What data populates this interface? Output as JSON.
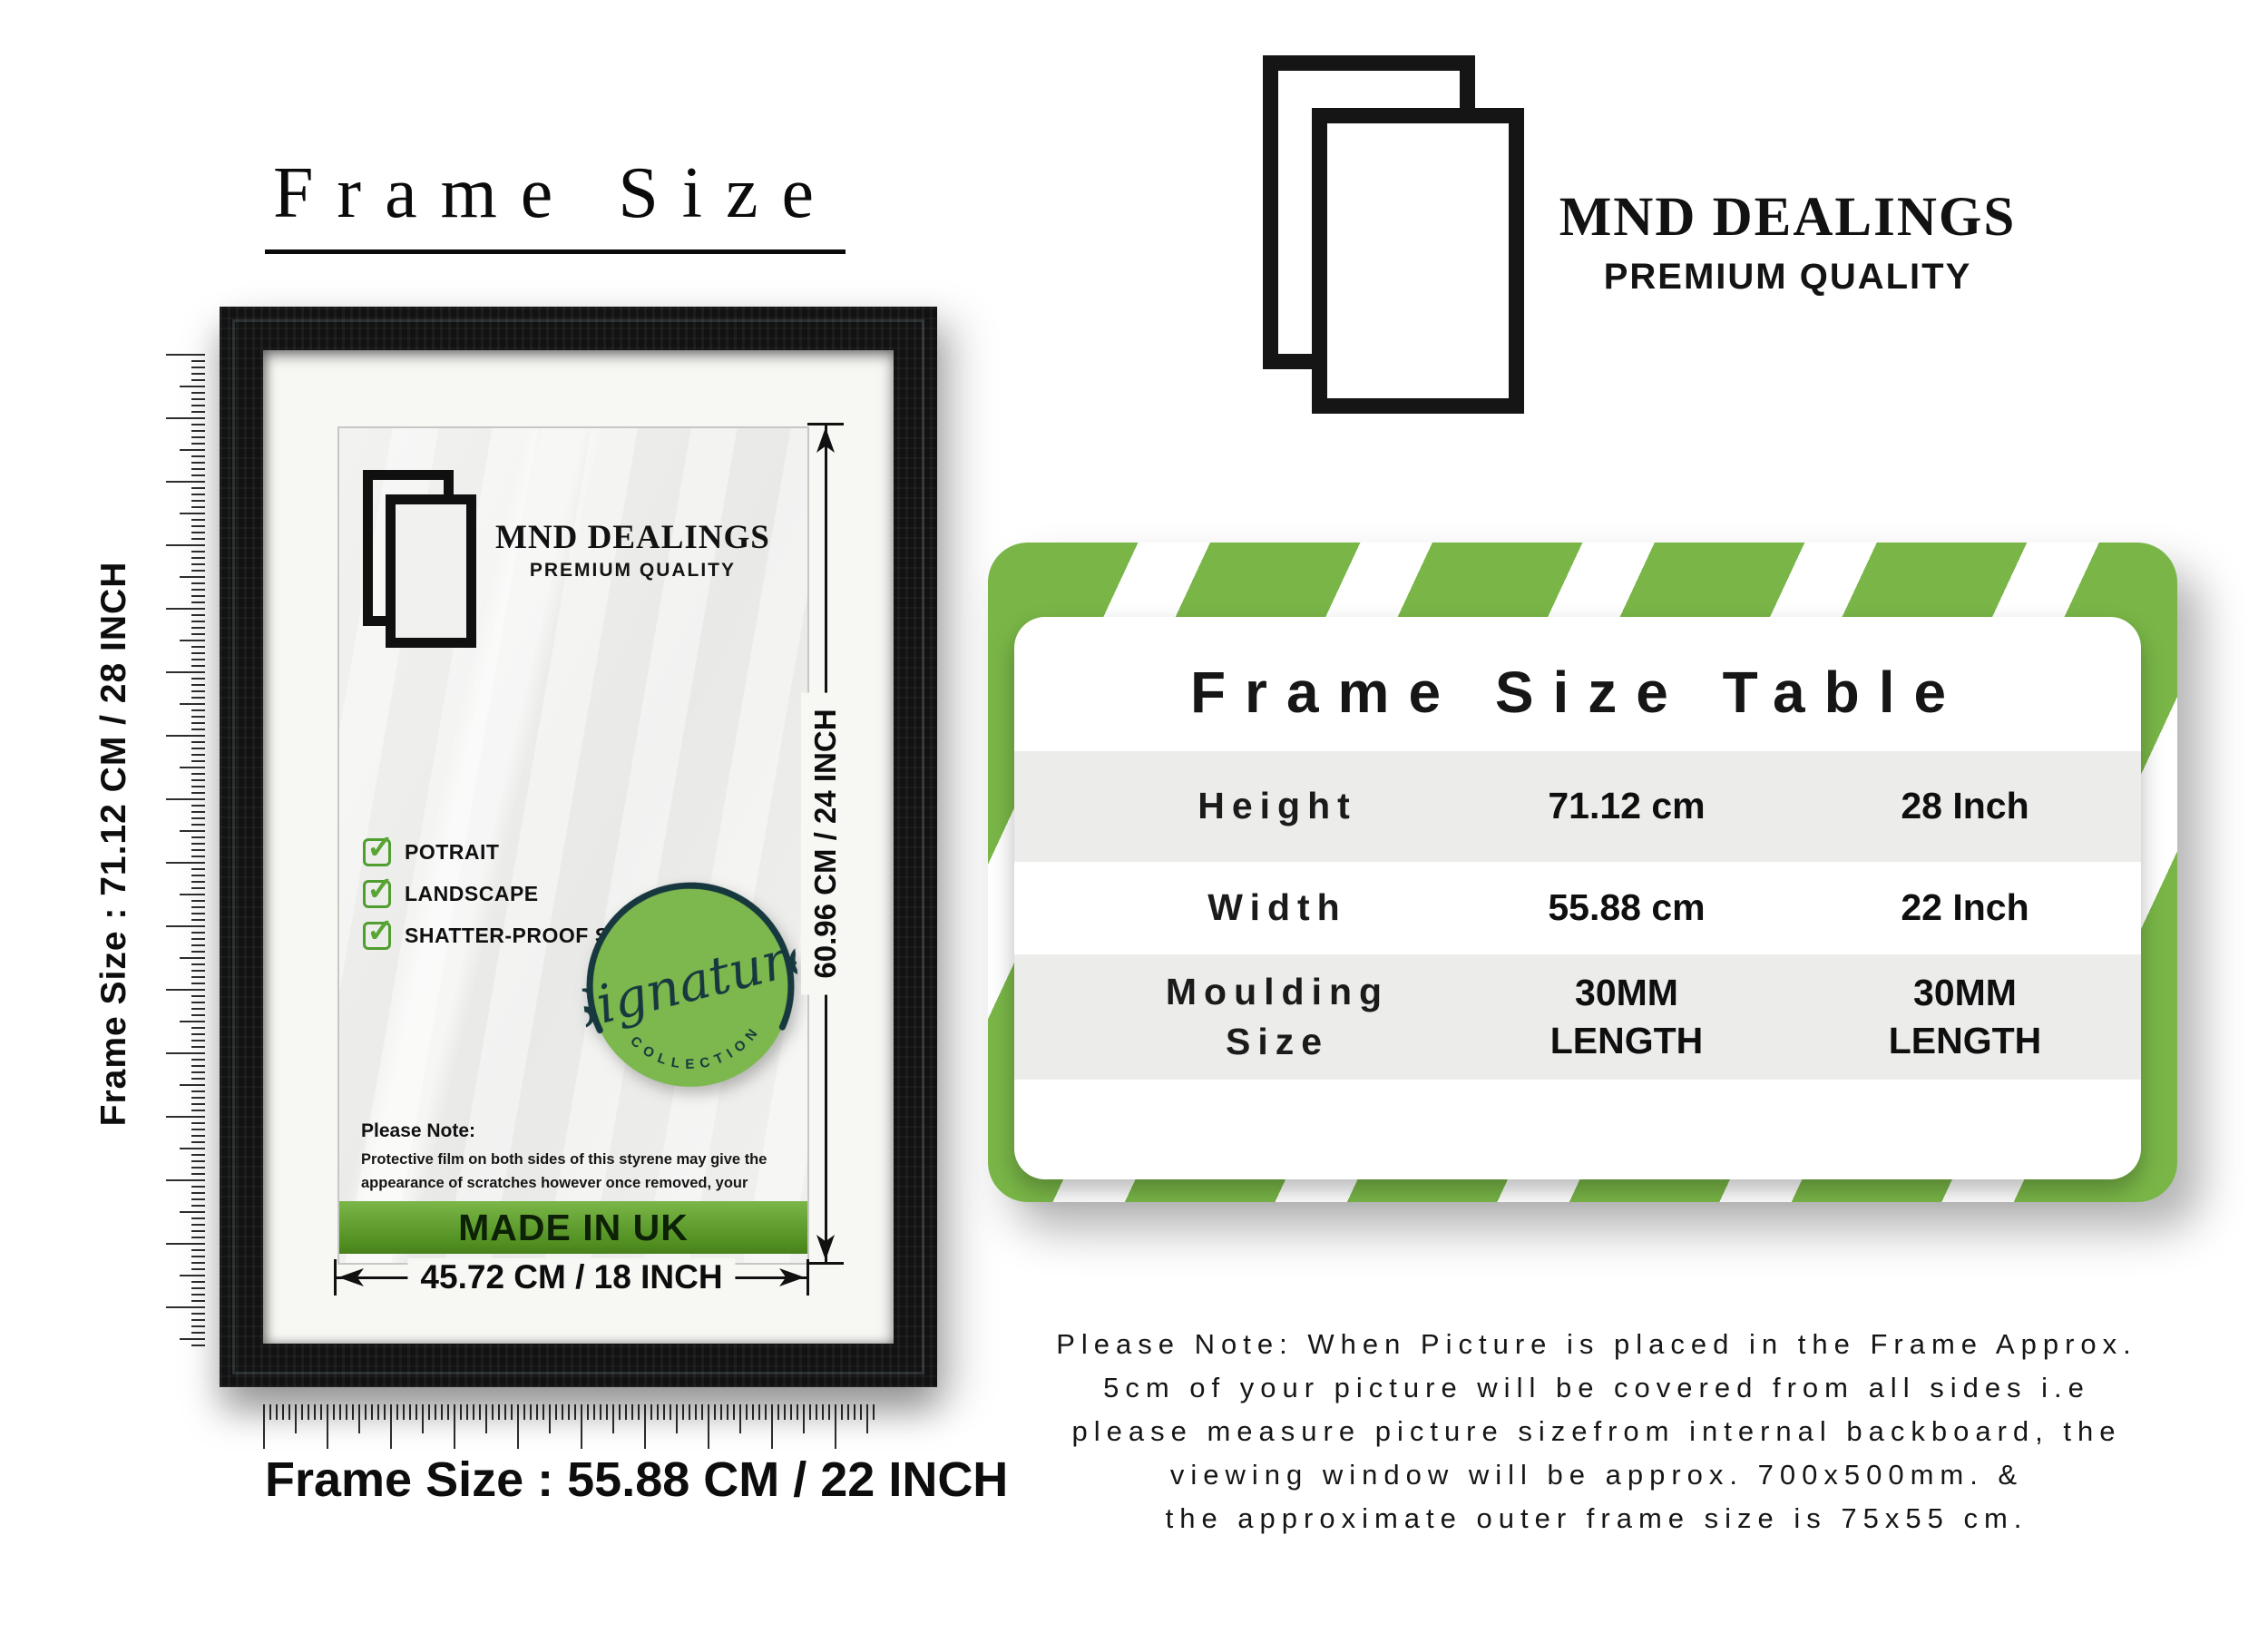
{
  "left": {
    "title": "Frame Size",
    "height_label": "Frame Size : 71.12 CM / 28 INCH",
    "width_label": "Frame Size : 55.88 CM / 22 INCH"
  },
  "frame": {
    "logo": {
      "name": "MND DEALINGS",
      "tagline": "PREMIUM QUALITY"
    },
    "features": [
      "POTRAIT",
      "LANDSCAPE",
      "SHATTER-PROOF STYRENE"
    ],
    "badge": {
      "script": "Signature",
      "arc": "COLLECTION"
    },
    "note": {
      "title": "Please Note:",
      "body": "Protective film on both sides of this styrene may give the appearance of scratches however once removed, your styrene is perfectly clear,"
    },
    "made_in": "MADE IN UK",
    "dims": {
      "height": "60.96 CM / 24 INCH",
      "width": "45.72 CM / 18 INCH"
    }
  },
  "brand": {
    "name": "MND DEALINGS",
    "tagline": "PREMIUM QUALITY"
  },
  "table": {
    "title": "Frame Size Table",
    "rows": [
      {
        "label": "Height",
        "cm": "71.12 cm",
        "inch": "28 Inch"
      },
      {
        "label": "Width",
        "cm": "55.88 cm",
        "inch": "22 Inch"
      },
      {
        "label": "Moulding Size",
        "cm": "30MM LENGTH",
        "inch": "30MM LENGTH"
      }
    ]
  },
  "footer": {
    "lines": [
      "Please Note: When Picture is placed in the Frame Approx.",
      "5cm of your picture will be covered from all sides i.e",
      "please measure picture sizefrom internal backboard, the",
      "viewing window will be approx. 700x500mm. &",
      "the approximate outer frame size is 75x55 cm."
    ]
  },
  "colors": {
    "accent_green": "#79b647",
    "made_in_uk_dark": "#47801b",
    "table_row_gray": "#ececeb"
  }
}
